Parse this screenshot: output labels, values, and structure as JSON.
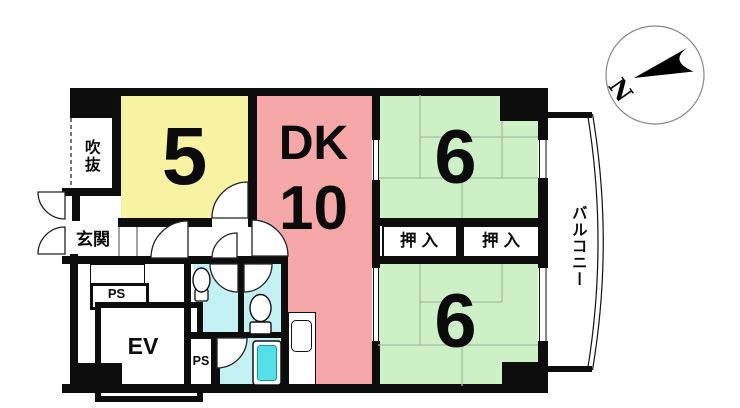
{
  "colors": {
    "wall": "#0d0d0d",
    "room5": "#f8f2a3",
    "dk": "#f5a8a7",
    "tatami": "#cdf0c6",
    "tatami_line": "#a4bba2",
    "wet": "#c3f1f4",
    "tub": "#55dfe9",
    "shelf": "#d9bd7f",
    "shelf_line": "#5c4d22"
  },
  "rooms": {
    "void": {
      "label": "吹抜"
    },
    "room5": {
      "label": "5"
    },
    "dk": {
      "name": "DK",
      "size": "10"
    },
    "room6_top": {
      "label": "6"
    },
    "room6_bottom": {
      "label": "6"
    },
    "closet_left": {
      "label": "押入"
    },
    "closet_right": {
      "label": "押入"
    },
    "genkan": {
      "label": "玄関"
    },
    "ps_upper": {
      "label": "PS"
    },
    "ps_lower": {
      "label": "PS"
    },
    "elevator": {
      "label": "EV"
    },
    "balcony": {
      "label": "バルコニー"
    }
  },
  "compass": {
    "label": "N"
  }
}
